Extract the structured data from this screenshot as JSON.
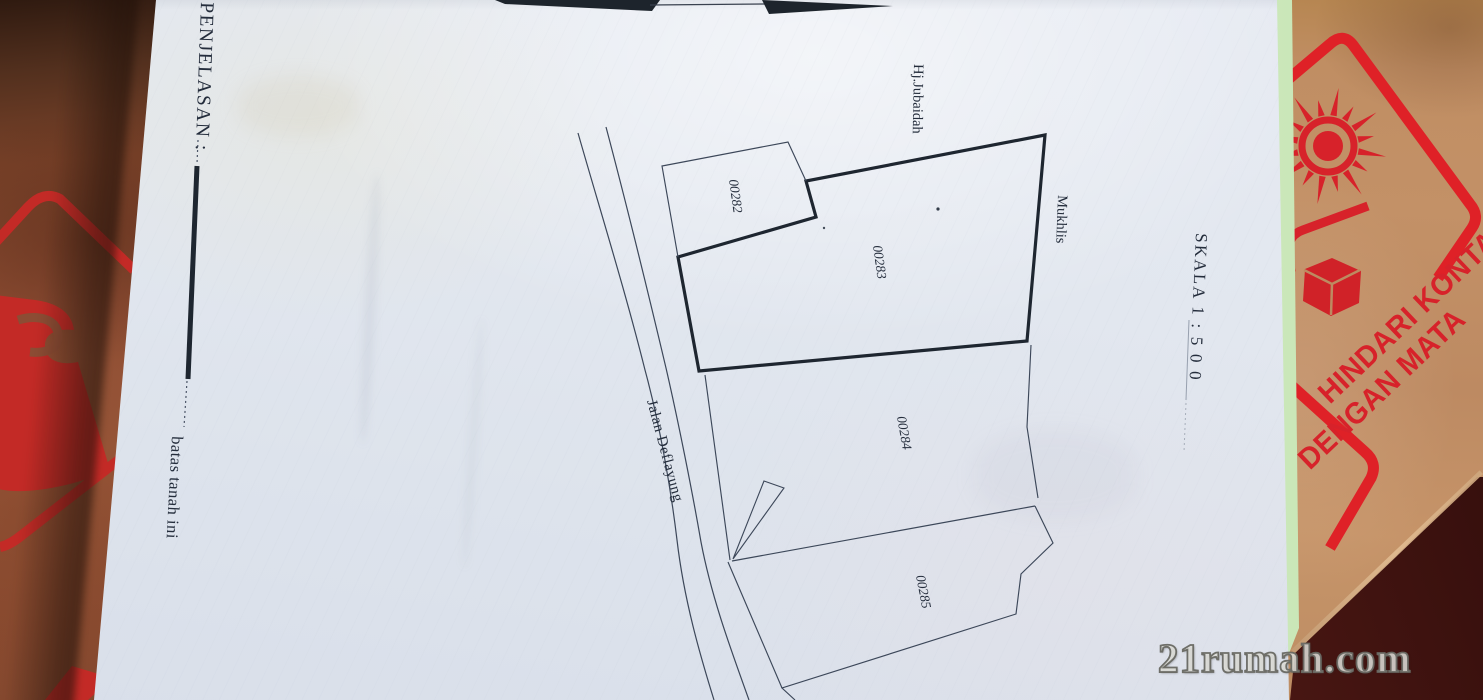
{
  "photo": {
    "watermark_text": "21rumah.com"
  },
  "survey_document": {
    "legend_title": "PENJELASAN :",
    "legend_item_label": "batas tanah ini",
    "scale_text": "SKALA 1 : 5 0 0",
    "road_name": "Jalan Deflayung",
    "adjacent_owners": [
      "Hj.Jubaidah",
      "Mukhlis"
    ],
    "parcel_numbers": [
      "00282",
      "00283",
      "00284",
      "00285"
    ]
  },
  "cardboard_print": {
    "warning_line1": "HINDARI KONTA",
    "warning_line2": "DENGAN MATA"
  },
  "colors": {
    "print_red": "#d7222a",
    "cardboard_tan": "#bd8a62",
    "cardboard_brown": "#8c4a31",
    "paper": "#e2e7ef",
    "green_edge": "#c8e7b6",
    "maroon_corner": "#5c2320",
    "ink": "#222b38"
  }
}
